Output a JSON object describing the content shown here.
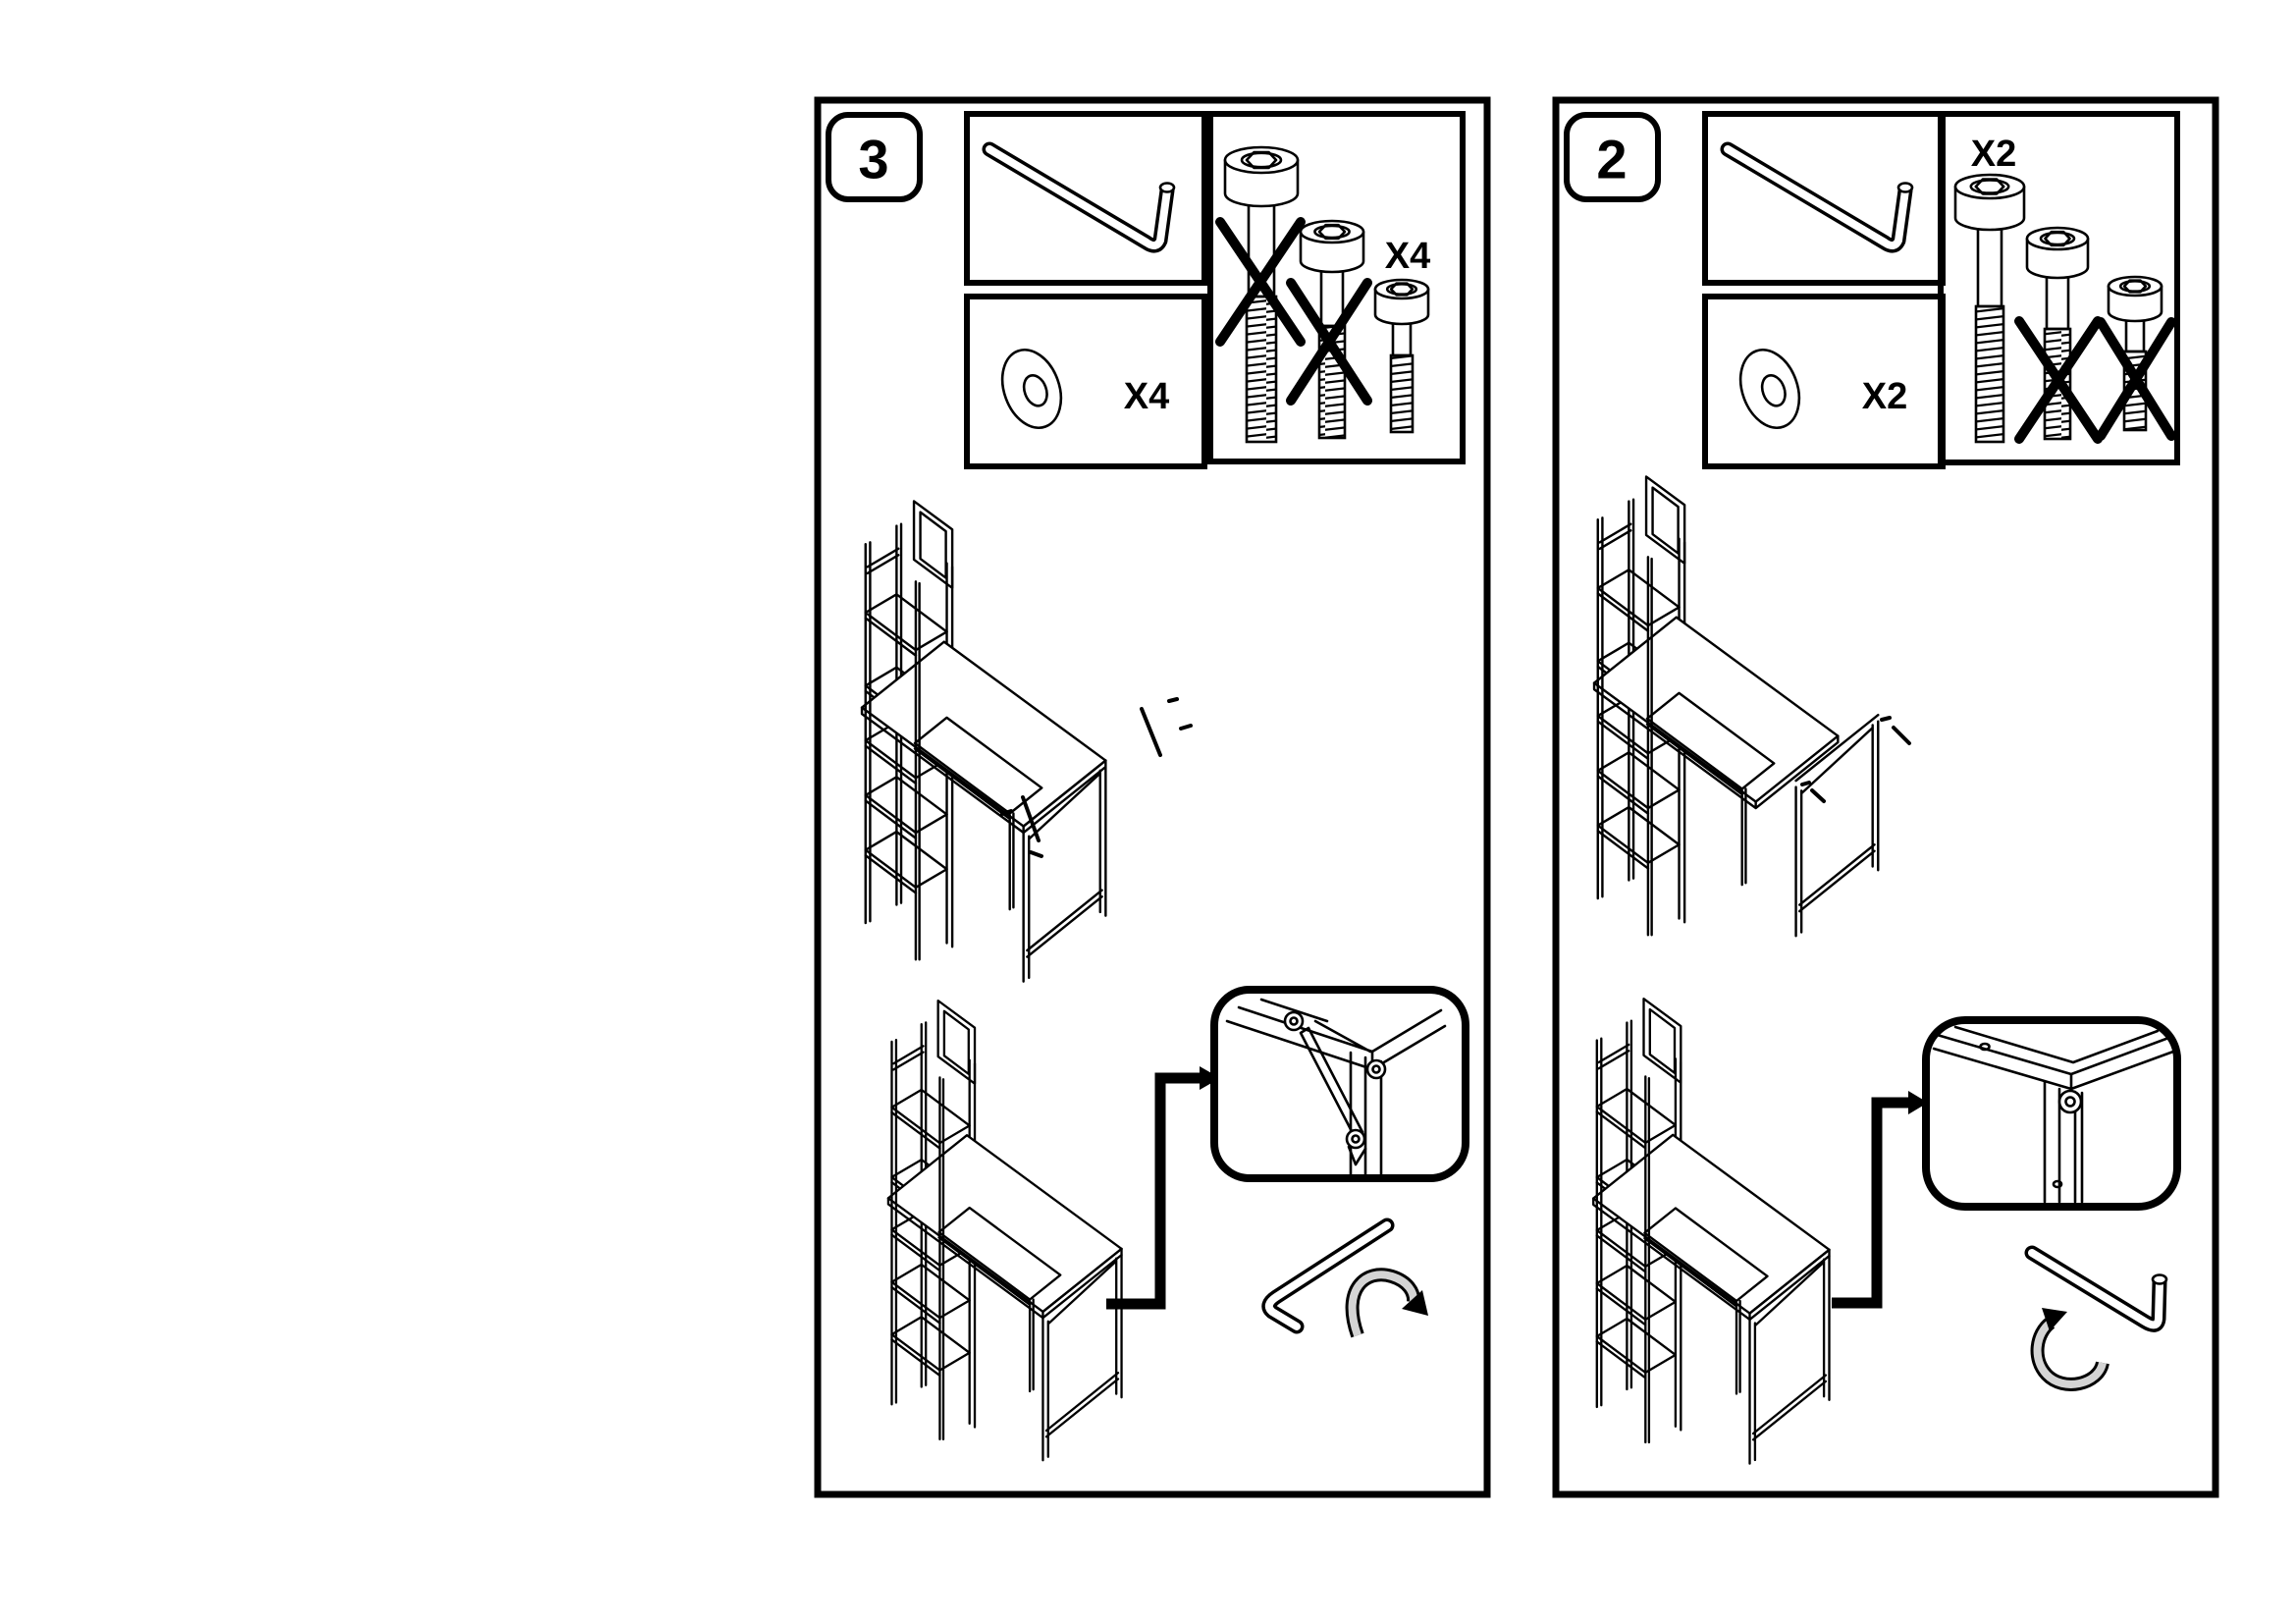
{
  "document": {
    "kind": "assembly-instruction-sheet",
    "background": "#ffffff",
    "ink_color": "#000000"
  },
  "panels": [
    {
      "step_label": "3",
      "tool_box": {
        "icon": "allen-key-icon"
      },
      "washer_box": {
        "icon": "washer-icon",
        "count_label": "X4"
      },
      "bolt_box": {
        "count_label": "X4",
        "bolts": [
          {
            "icon": "bolt-long-icon",
            "crossed_out": true
          },
          {
            "icon": "bolt-medium-icon",
            "crossed_out": true
          },
          {
            "icon": "bolt-short-icon",
            "crossed_out": false
          }
        ]
      },
      "diagrams": [
        {
          "name": "desk-with-side-frame-and-bolt-positions",
          "icons": [
            "desk-with-shelf-tower",
            "bolt-insert-indicator",
            "bolt-insert-indicator"
          ]
        },
        {
          "name": "tighten-corner-brace",
          "icons": [
            "desk-with-shelf-tower",
            "elbow-arrow",
            "detail-callout-corner-brace",
            "allen-key-icon",
            "rotate-clockwise-arrow"
          ]
        }
      ]
    },
    {
      "step_label": "2",
      "tool_box": {
        "icon": "allen-key-icon"
      },
      "washer_box": {
        "icon": "washer-icon",
        "count_label": "X2"
      },
      "bolt_box": {
        "count_label": "X2",
        "bolts": [
          {
            "icon": "bolt-long-icon",
            "crossed_out": false
          },
          {
            "icon": "bolt-medium-icon",
            "crossed_out": true
          },
          {
            "icon": "bolt-short-icon",
            "crossed_out": true
          }
        ]
      },
      "diagrams": [
        {
          "name": "position-side-frame-exploded",
          "icons": [
            "desk-with-shelf-tower",
            "side-frame",
            "bolt-insert-indicator",
            "bolt-insert-indicator"
          ]
        },
        {
          "name": "tighten-corner-bolt",
          "icons": [
            "desk-with-shelf-tower",
            "elbow-arrow",
            "detail-callout-corner-bolt",
            "allen-key-icon",
            "rotate-counterclockwise-arrow"
          ]
        }
      ]
    }
  ]
}
